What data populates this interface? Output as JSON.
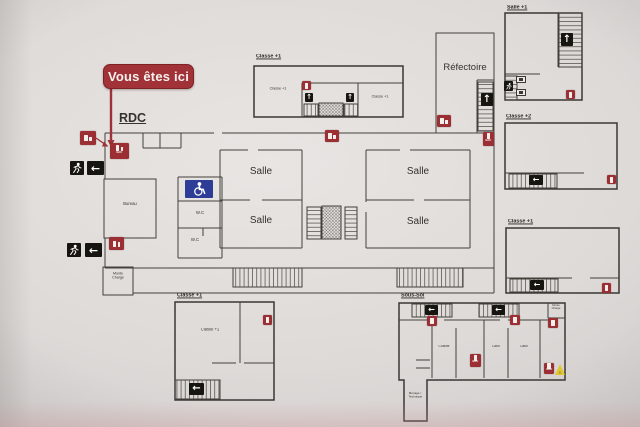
{
  "plan": {
    "you_are_here": "Vous êtes ici",
    "floor_label": "RDC",
    "rooms": {
      "refectoire": "Réfectoire",
      "salle_center_top": "Salle",
      "salle_center_bottom": "Salle",
      "salle_right_top": "Salle",
      "salle_right_bottom": "Salle",
      "bureau": "Bureau",
      "monte_charge": "Monte Charge",
      "wc_top": "W.C",
      "wc_bottom": "W.C"
    }
  },
  "insets": {
    "classe_plus1_top": {
      "title": "Classe +1",
      "room_left": "Classe +1",
      "room_right": "Classe +1"
    },
    "salle_plus1": {
      "title": "Salle +1"
    },
    "classe_plus2": {
      "title": "Classe +2"
    },
    "classe_plus1_right": {
      "title": "Classe +1"
    },
    "classe_plus1_bottom": {
      "title": "Classe +1",
      "room": "Classe +1"
    },
    "sous_sol": {
      "title": "Sous-Sol",
      "rooms": {
        "cuisine": "Cuisine",
        "labo_1": "Labo",
        "labo_2": "Labo",
        "menage": "Ménage / Technique",
        "monte_charge": "Monte Charge"
      }
    }
  },
  "icons": {
    "arrow_left": "←",
    "arrow_up": "↑",
    "extinguisher_water_label": "EAU",
    "warning_exclamation": "!"
  },
  "colors": {
    "marker_red": "#9e3238",
    "wall": "#44403b",
    "exit_black": "#17150f",
    "handicap_blue": "#2d3c96",
    "warning_yellow": "#e2c62e",
    "paper": "#dedad8"
  }
}
